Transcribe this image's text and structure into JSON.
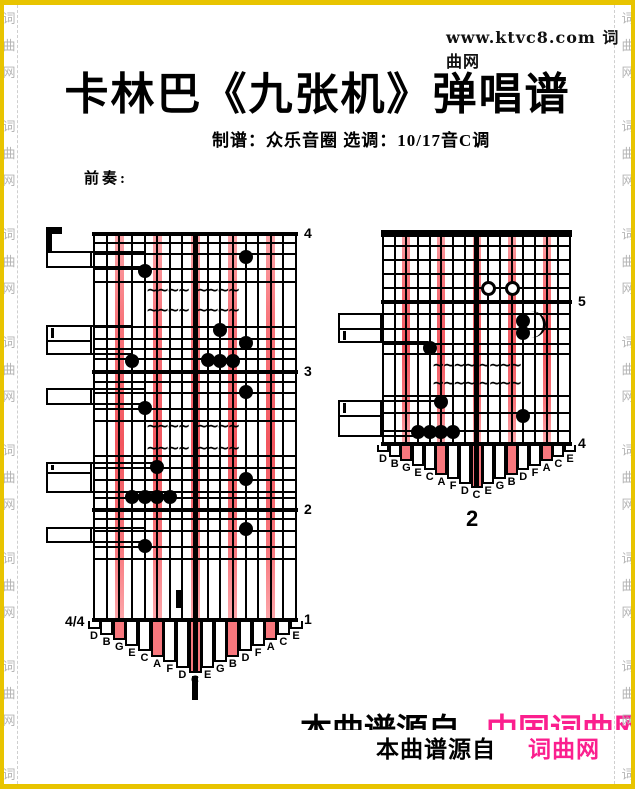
{
  "page": {
    "site_header": "www.ktvc8.com 词曲网",
    "title": "卡林巴《九张机》弹唱谱",
    "credits": "制谱：众乐音圈  选调：10/17音C调",
    "prelude_label": "前奏:",
    "footer_ghost": {
      "black": "本曲谱源自",
      "pink": "中国词曲网"
    },
    "footer": {
      "black": "本曲谱源自",
      "pink": "词曲网"
    },
    "watermark_chars": [
      "词",
      "曲",
      "网"
    ]
  },
  "colors": {
    "gold_border": "#e8c400",
    "stripe": "#f8777d",
    "pink_text": "#fb1f8e",
    "watermark_gray": "#b5b5b5",
    "dash_gray": "#cfcfcf"
  },
  "tablature": {
    "letters": [
      "D",
      "B",
      "G",
      "E",
      "C",
      "A",
      "F",
      "D",
      "C",
      "E",
      "G",
      "B",
      "D",
      "F",
      "A",
      "C",
      "E"
    ],
    "pink_tines": [
      3,
      6,
      9,
      12,
      15
    ],
    "time_signature": "4/4",
    "parts": [
      {
        "name": "part-1",
        "label": {
          "text": "1",
          "style": "bar",
          "x": 192,
          "y": 676,
          "w": 6,
          "h": 24
        },
        "grid": {
          "left": 94,
          "right": 296,
          "top": 232,
          "bottom": 618,
          "stripe_w": 9,
          "top_thick": 4
        },
        "measures": [
          {
            "y": 232,
            "n": "4"
          },
          {
            "y": 370,
            "n": "3"
          },
          {
            "y": 508,
            "n": "2"
          },
          {
            "y": 618,
            "n": "1",
            "time": "4/4"
          }
        ],
        "lines": [
          242,
          253,
          268,
          281,
          326,
          338,
          348,
          358,
          381,
          392,
          408,
          420,
          455,
          467,
          479,
          491,
          497,
          518,
          530,
          546,
          558
        ],
        "notes": [
          [
            13,
            257
          ],
          [
            5,
            271
          ],
          [
            11,
            330
          ],
          [
            13,
            343
          ],
          [
            10,
            360
          ],
          [
            11,
            361
          ],
          [
            12,
            361
          ],
          [
            4,
            361
          ],
          [
            13,
            392
          ],
          [
            5,
            408
          ],
          [
            6,
            467
          ],
          [
            13,
            479
          ],
          [
            4,
            497
          ],
          [
            5,
            497
          ],
          [
            6,
            497
          ],
          [
            7,
            497
          ],
          [
            13,
            529
          ],
          [
            5,
            546
          ]
        ],
        "open_notes": [],
        "wavies": [
          [
            146,
            292
          ],
          [
            196,
            292
          ],
          [
            146,
            312
          ],
          [
            196,
            312
          ],
          [
            146,
            428
          ],
          [
            196,
            428
          ],
          [
            146,
            450
          ],
          [
            196,
            450
          ]
        ],
        "ties": [],
        "boxes": [
          {
            "x": 46,
            "y": 251,
            "w": 46,
            "h": 17,
            "ext_top": 145,
            "ext_bot": 145
          },
          {
            "x": 46,
            "y": 325,
            "w": 46,
            "h": 30,
            "div": 340,
            "dbl": "top",
            "ext_top": 133,
            "ext_bot": 133
          },
          {
            "x": 46,
            "y": 388,
            "w": 46,
            "h": 17,
            "ext_top": 146,
            "ext_bot": 146
          },
          {
            "x": 46,
            "y": 462,
            "w": 46,
            "h": 31,
            "div": 472,
            "dbl": "top",
            "ext_top": 152,
            "ext_bot": 152
          },
          {
            "x": 46,
            "y": 527,
            "w": 46,
            "h": 16,
            "ext_top": 145,
            "ext_bot": 145
          }
        ],
        "marks": [
          {
            "x": 176,
            "y": 590,
            "w": 5,
            "h": 18
          }
        ],
        "corner": {
          "x": 46,
          "y": 227,
          "w": 6,
          "h": 24,
          "hw": 16,
          "hh": 7
        },
        "tip": {
          "base": 8,
          "step": 5.5
        }
      },
      {
        "name": "part-2",
        "label": {
          "text": "2",
          "style": "text",
          "x": 466,
          "y": 506
        },
        "grid": {
          "left": 383,
          "right": 570,
          "top": 230,
          "bottom": 442,
          "stripe_w": 8,
          "top_thick": 7
        },
        "measures": [
          {
            "y": 300,
            "n": "5"
          },
          {
            "y": 442,
            "n": "4"
          }
        ],
        "lines": [
          245,
          259,
          273,
          287,
          313,
          328,
          343,
          353,
          395,
          412,
          430
        ],
        "notes": [
          [
            13,
            321
          ],
          [
            13,
            333
          ],
          [
            5,
            348
          ],
          [
            6,
            402
          ],
          [
            13,
            416
          ],
          [
            4,
            432
          ],
          [
            5,
            432
          ],
          [
            6,
            432
          ],
          [
            7,
            432
          ]
        ],
        "open_notes": [
          [
            10,
            288
          ],
          [
            12,
            288
          ]
        ],
        "wavies": [
          [
            432,
            367
          ],
          [
            478,
            367
          ],
          [
            432,
            385
          ],
          [
            478,
            385
          ]
        ],
        "ties": [
          {
            "x": 531,
            "y": 311,
            "w": 12,
            "h": 27
          }
        ],
        "boxes": [
          {
            "x": 338,
            "y": 313,
            "w": 44,
            "h": 30,
            "div": 328,
            "dbl": "bottom",
            "ext_top": 520,
            "ext_bot": 428
          },
          {
            "x": 338,
            "y": 400,
            "w": 44,
            "h": 37,
            "div": 415,
            "dbl": "top",
            "ext_top": 441,
            "ext_bot": 414
          }
        ],
        "marks": [],
        "tip": {
          "base": 7,
          "step": 4.5
        }
      }
    ]
  }
}
